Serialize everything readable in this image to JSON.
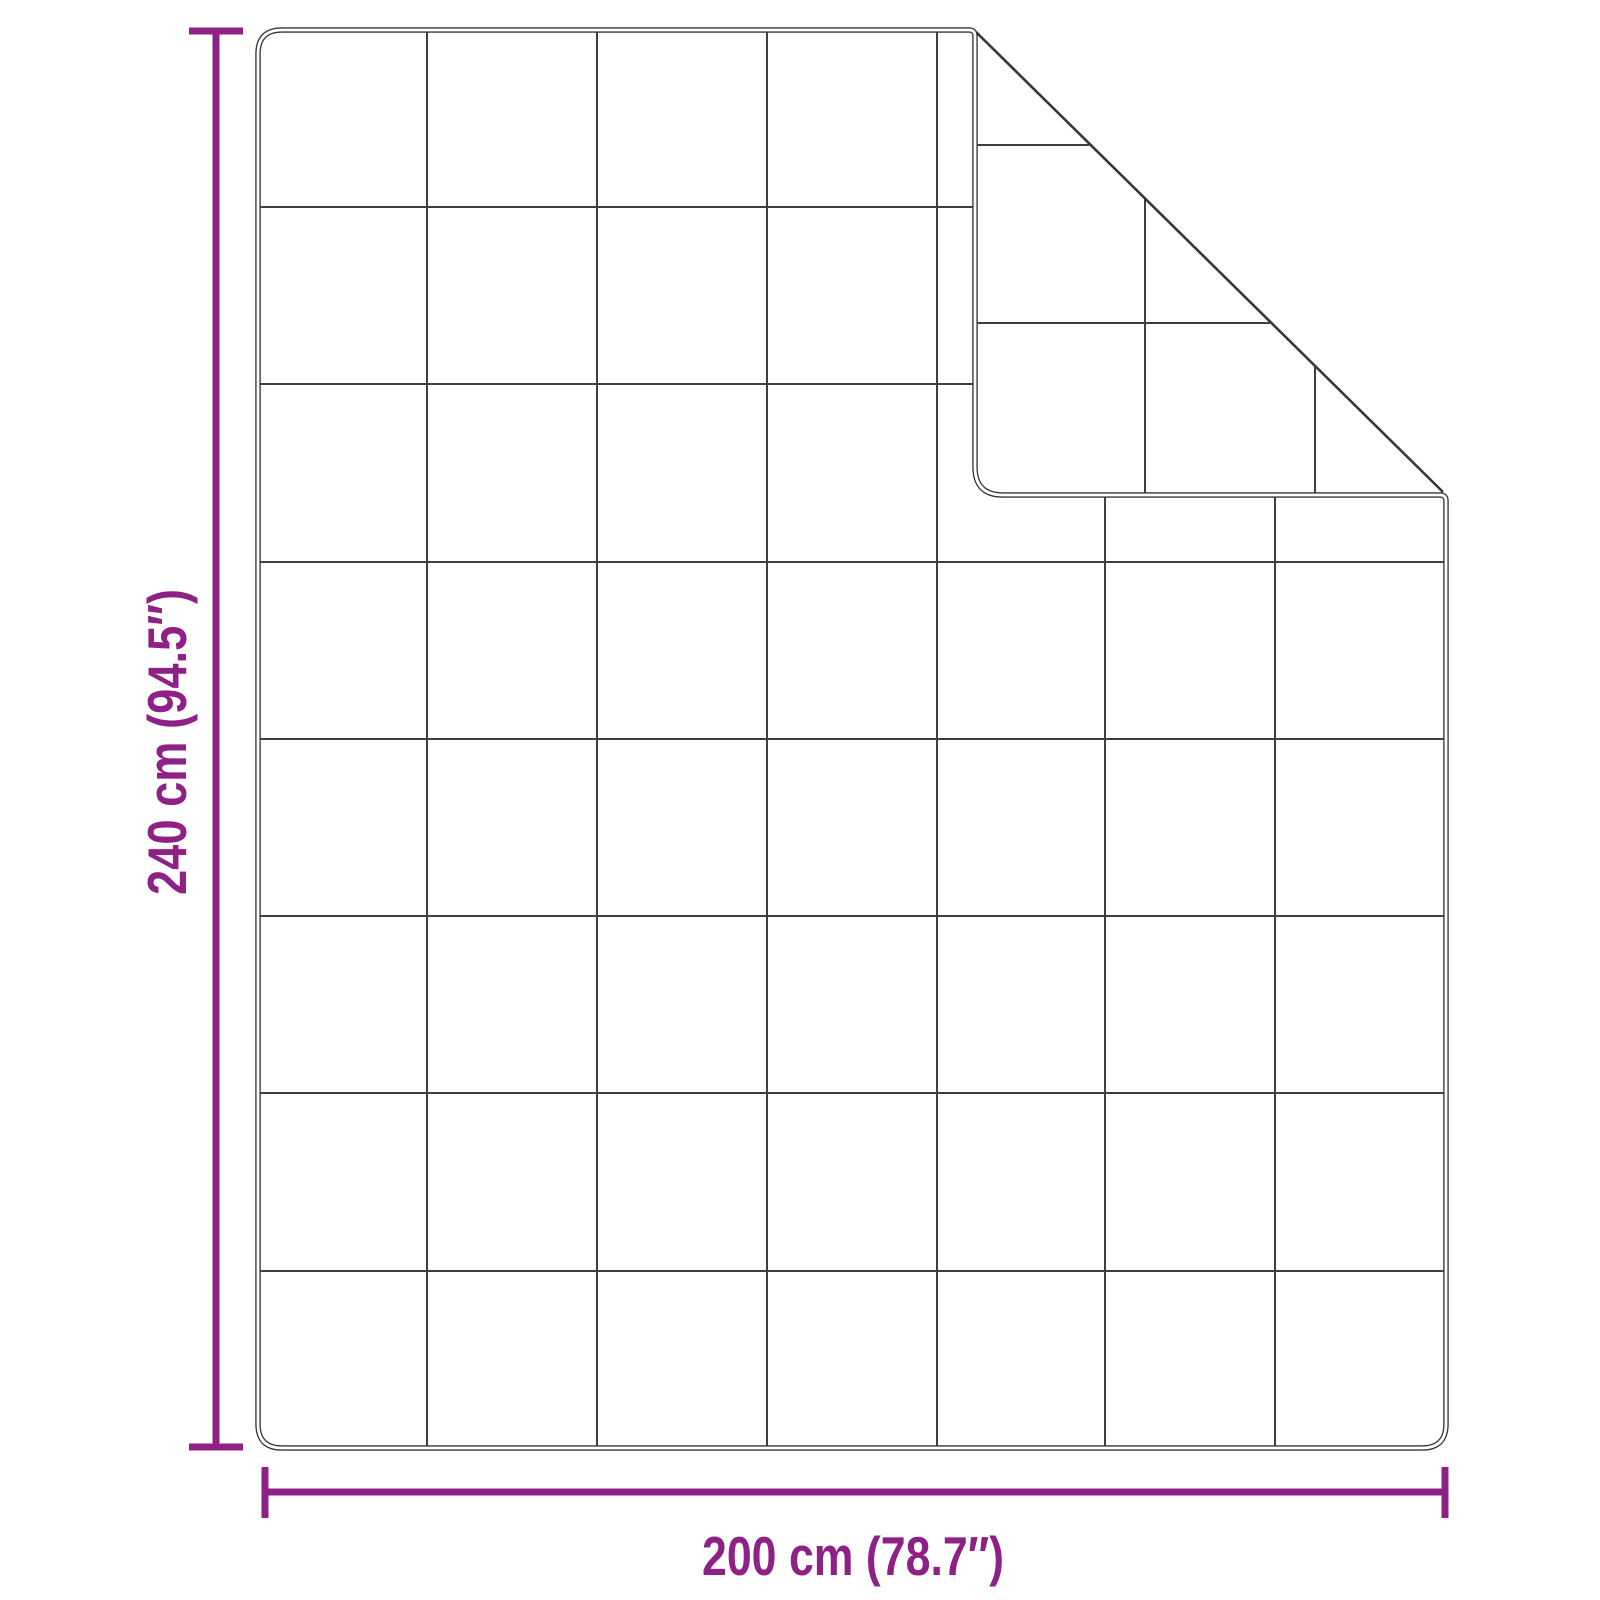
{
  "labels": {
    "height": "240 cm (94.5″)",
    "width": "200 cm (78.7″)"
  },
  "colors": {
    "accent": "#8F2086",
    "outline": "#373737",
    "grid": "#3F3F3F",
    "background": "#FFFFFF"
  },
  "blanket": {
    "grid_columns": 7,
    "grid_rows": 8,
    "fold": "top-right corner folded over showing quilted underside"
  }
}
